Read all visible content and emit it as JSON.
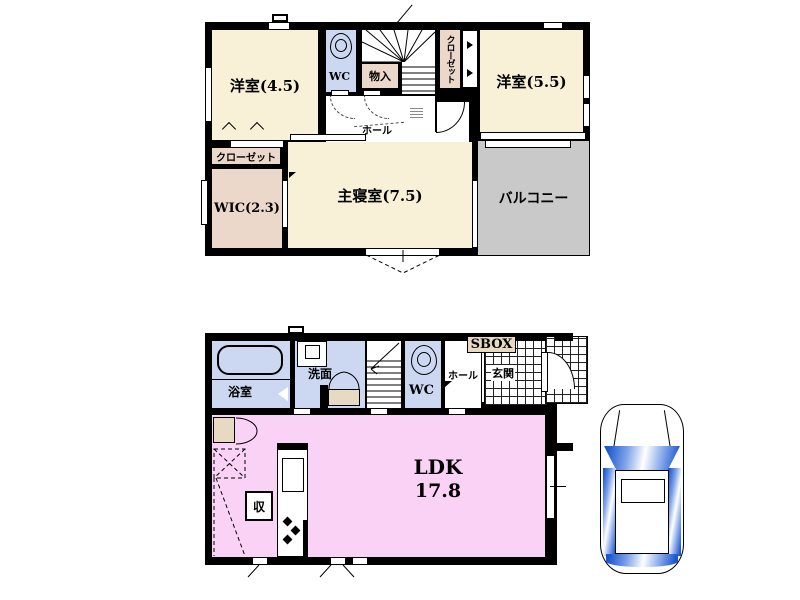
{
  "colors": {
    "wall": "#000000",
    "room_cream": "#f8f1d7",
    "room_tan": "#ecd8ca",
    "room_blue": "#ccd8f2",
    "room_pink": "#f9d2f5",
    "cabinet_beige": "#e8dac2",
    "balcony_gray": "#c9c9c9",
    "glass_blue": "#1b57cf"
  },
  "floor2": {
    "bedroom_45": "洋室(4.5)",
    "wc": "WC",
    "storage_closet": "物入",
    "closet_top": "クローゼット",
    "bedroom_55": "洋室(5.5)",
    "hall": "ホール",
    "closet": "クローゼット",
    "wic": "WIC(2.3)",
    "master_bedroom": "主寝室(7.5)",
    "balcony": "バルコニー"
  },
  "floor1": {
    "bathroom": "浴室",
    "washroom": "洗面",
    "wc": "WC",
    "hall": "ホール",
    "shoe_box": "SBOX",
    "entrance": "玄関",
    "ldk_label": "LDK",
    "ldk_size": "17.8",
    "storage": "収"
  },
  "icons": {
    "toilet": "ellipse-outline",
    "bathtub": "rounded-rect-outline",
    "washbasin": "nested-rects",
    "staircase": "tread-lines",
    "kitchen_counter": "rect-sink-burners",
    "car": "top-view-car-with-blue-glass"
  }
}
